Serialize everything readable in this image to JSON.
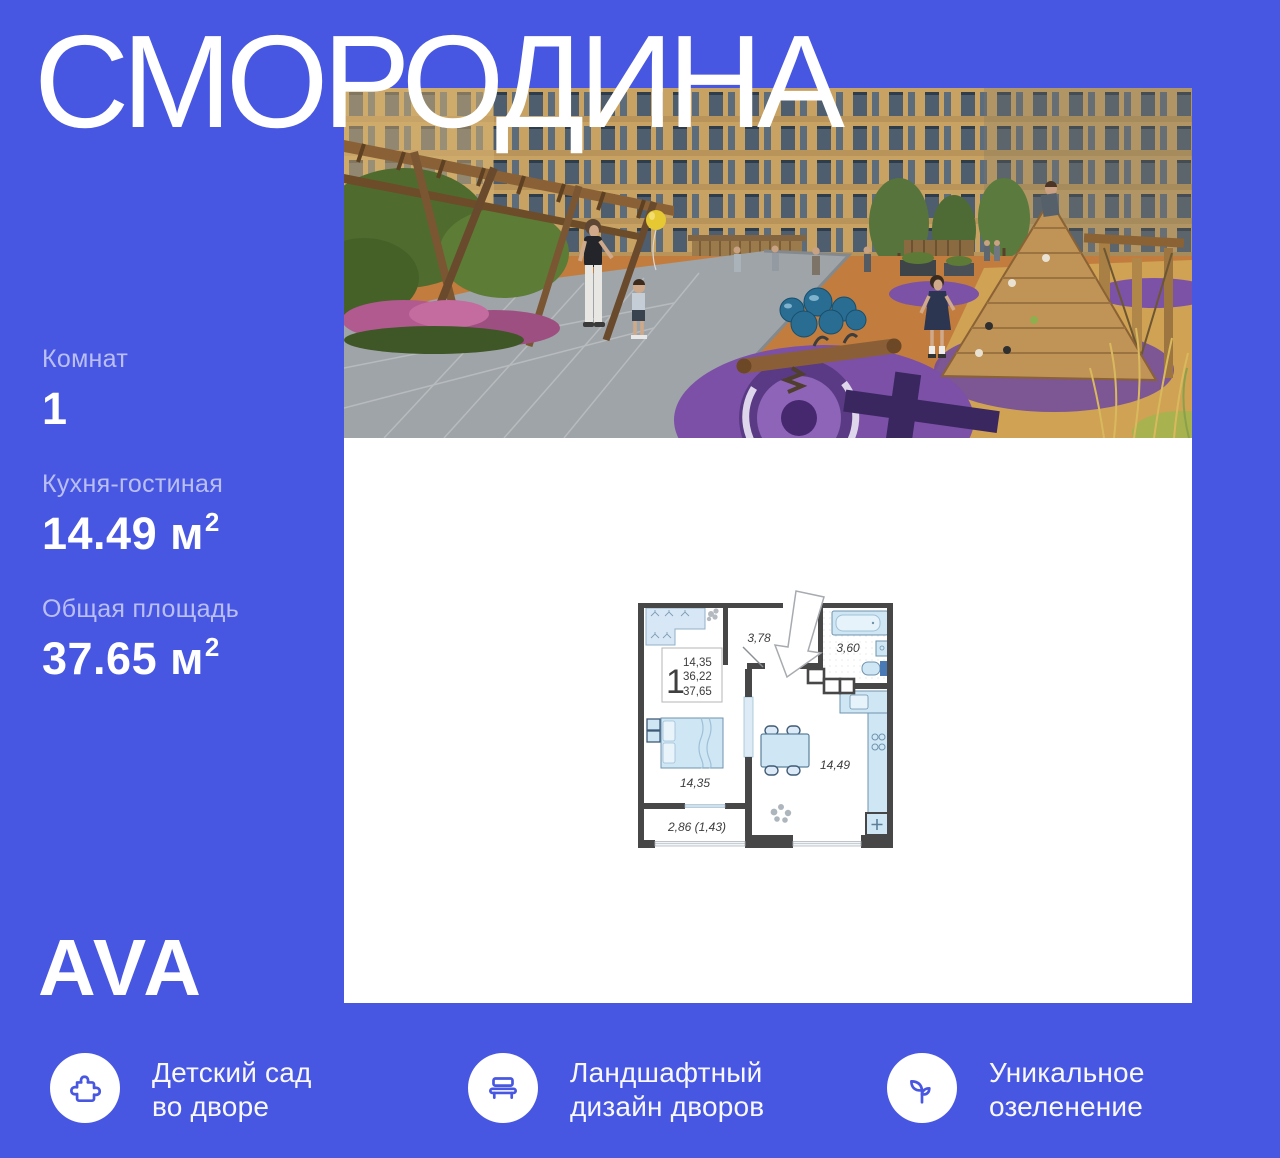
{
  "colors": {
    "background": "#4857E2",
    "panel": "#FFFFFF",
    "text": "#FFFFFF",
    "muted_label": "rgba(255,255,255,0.62)",
    "icon_stroke": "#4857E2",
    "plan_walls": "#474747",
    "plan_furniture": "#CFE4F4"
  },
  "title": "СМОРОДИНА",
  "logo": "AVA",
  "stats": [
    {
      "label": "Комнат",
      "value": "1",
      "sup": ""
    },
    {
      "label": "Кухня-гостиная",
      "value": "14.49 м",
      "sup": "2"
    },
    {
      "label": "Общая площадь",
      "value": "37.65 м",
      "sup": "2"
    }
  ],
  "features": [
    {
      "icon": "puzzle-icon",
      "line1": "Детский сад",
      "line2": "во дворе"
    },
    {
      "icon": "bench-icon",
      "line1": "Ландшафтный",
      "line2": "дизайн дворов"
    },
    {
      "icon": "sprout-icon",
      "line1": "Уникальное",
      "line2": "озеленение"
    }
  ],
  "floorplan": {
    "rooms_badge": "1",
    "areas": {
      "line1": "14,35",
      "line2": "36,22",
      "line3": "37,65"
    },
    "labels": {
      "hallway": "3,78",
      "bathroom": "3,60",
      "bedroom": "14,35",
      "kitchen_living": "14,49",
      "balcony": "2,86 (1,43)"
    }
  }
}
